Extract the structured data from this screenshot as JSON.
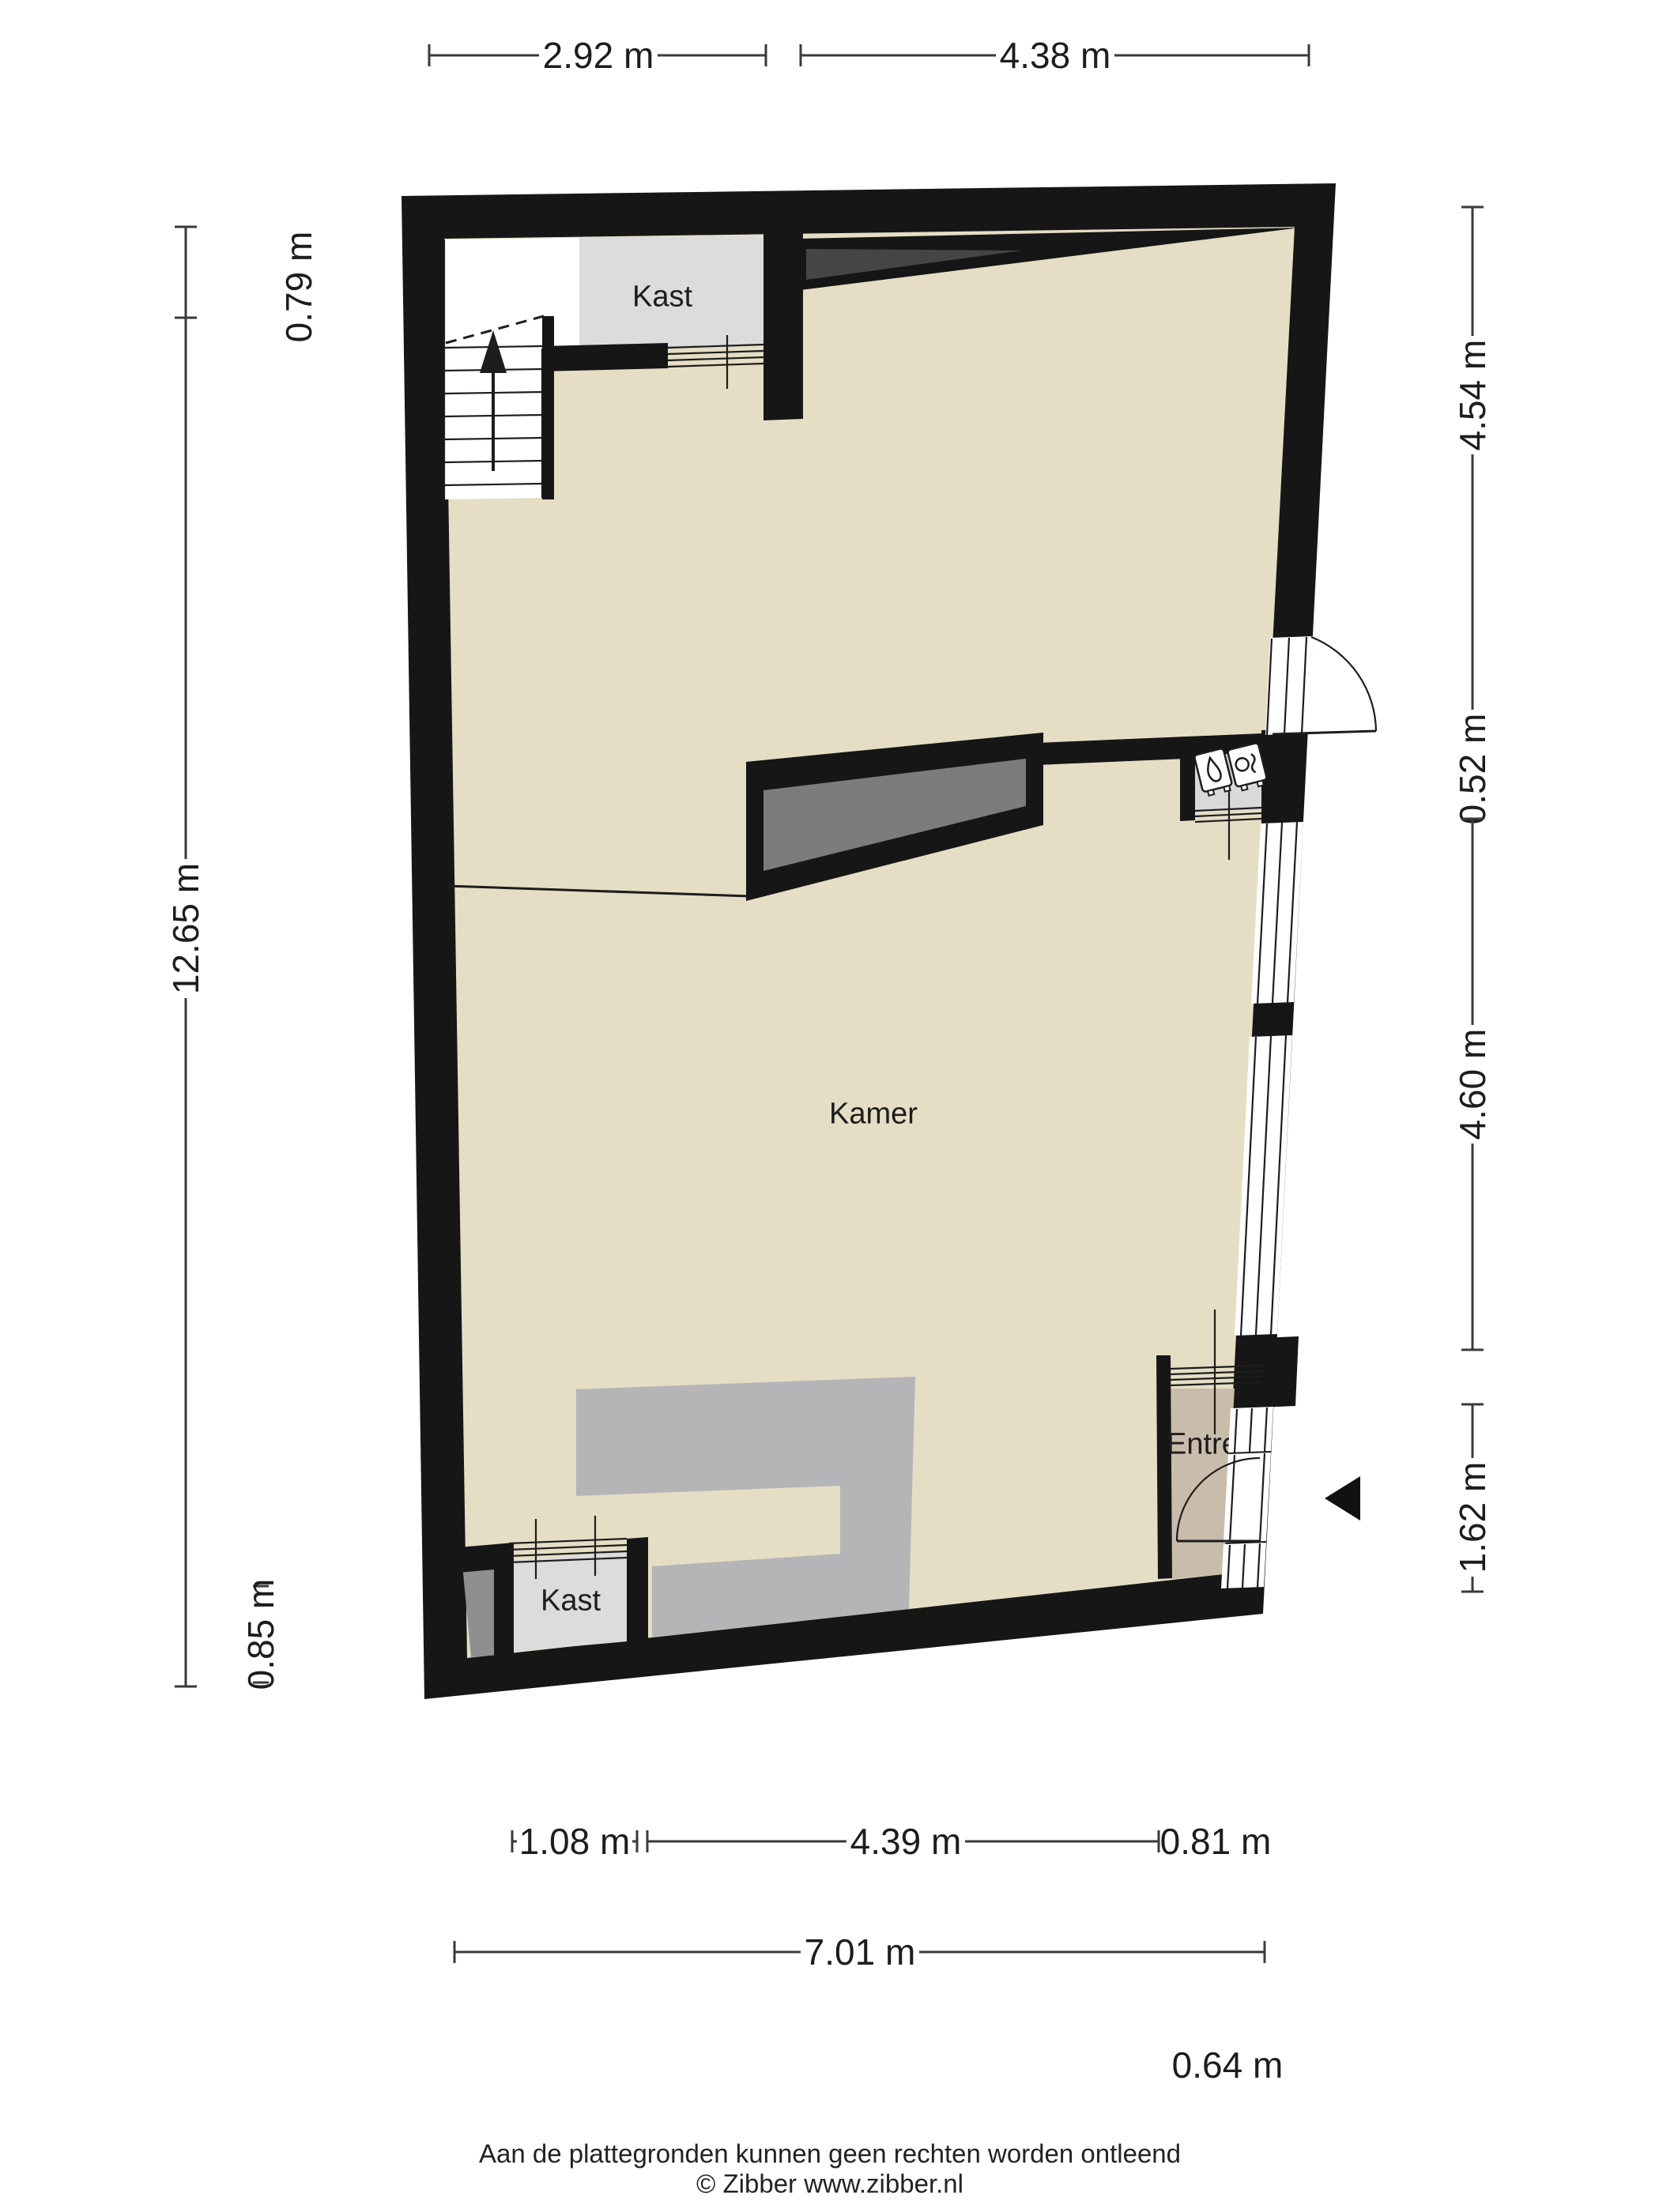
{
  "labels": {
    "room_main": "Kamer",
    "closet_top": "Kast",
    "closet_bottom": "Kast",
    "entry": "Entree"
  },
  "dimensions": {
    "top": [
      "2.92 m",
      "4.38 m"
    ],
    "left": [
      "0.79 m",
      "12.65 m",
      "0.85 m"
    ],
    "right": [
      "4.54 m",
      "0.52 m",
      "4.60 m",
      "1.62 m"
    ],
    "bottom_row1": [
      "1.08 m",
      "4.39 m",
      "0.81 m"
    ],
    "bottom_row2": [
      "7.01 m"
    ],
    "bottom_row3": [
      "0.64 m"
    ]
  },
  "footer": {
    "disclaimer": "Aan de plattegronden kunnen geen rechten worden ontleend",
    "credit": "© Zibber www.zibber.nl"
  },
  "colors": {
    "wall": "#161616",
    "floor": "#e5dec5",
    "entree_floor": "#c9bcab",
    "closet": "#dcdcdc",
    "meter_closet": "#d9d9d9",
    "counter": "#b5b5b7",
    "dark_bar": "#7c7c7c",
    "niche": "#8f8f8f",
    "wedge": "#454545",
    "dim_line": "#3a3a3a"
  }
}
